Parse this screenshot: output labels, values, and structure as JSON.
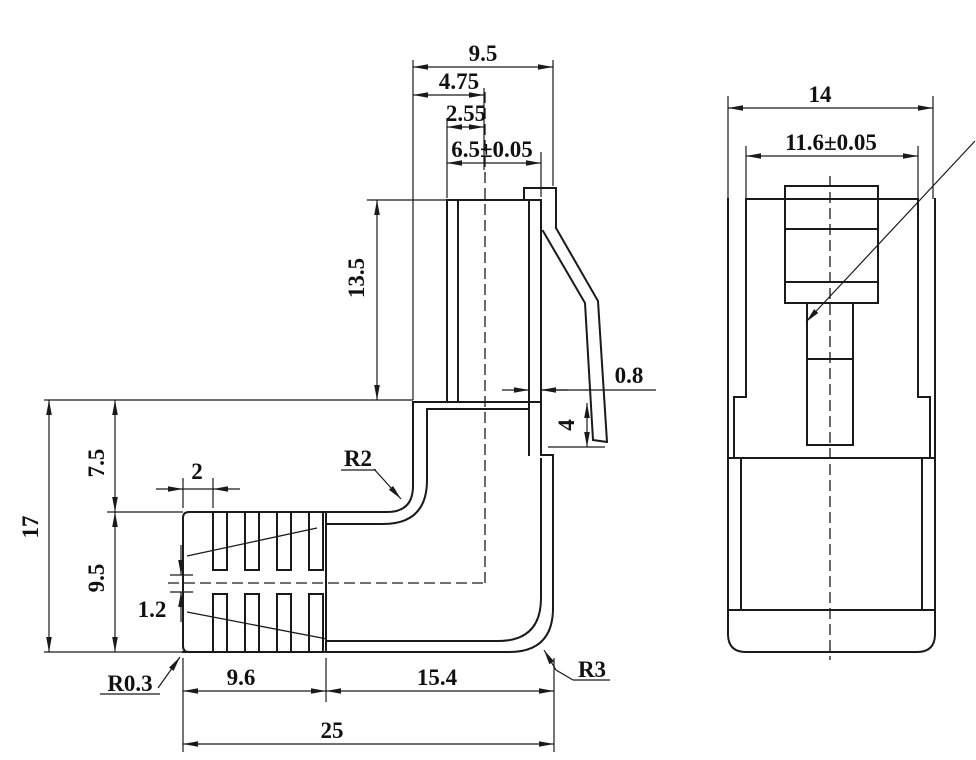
{
  "drawing": {
    "type": "2D technical drawing - right-angle modular plug (two views)",
    "background_color": "#ffffff",
    "line_color": "#1a1a1a",
    "dimensions": {
      "plug_depth": "9.5",
      "plug_half": "4.75",
      "plug_offset": "2.55",
      "tip_width": "6.5±0.05",
      "plug_height": "13.5",
      "wall_thickness": "0.8",
      "latch_drop": "4",
      "overall_height": "17",
      "upper_height": "7.5",
      "lower_height": "9.5",
      "rib_pitch": "2",
      "rib_web": "1.2",
      "radius_small": "R0.3",
      "radius_inner": "R2",
      "radius_outer": "R3",
      "boot_length": "9.6",
      "body_length": "15.4",
      "overall_length": "25",
      "front_width": "14",
      "front_window_width": "11.6±0.05"
    }
  }
}
